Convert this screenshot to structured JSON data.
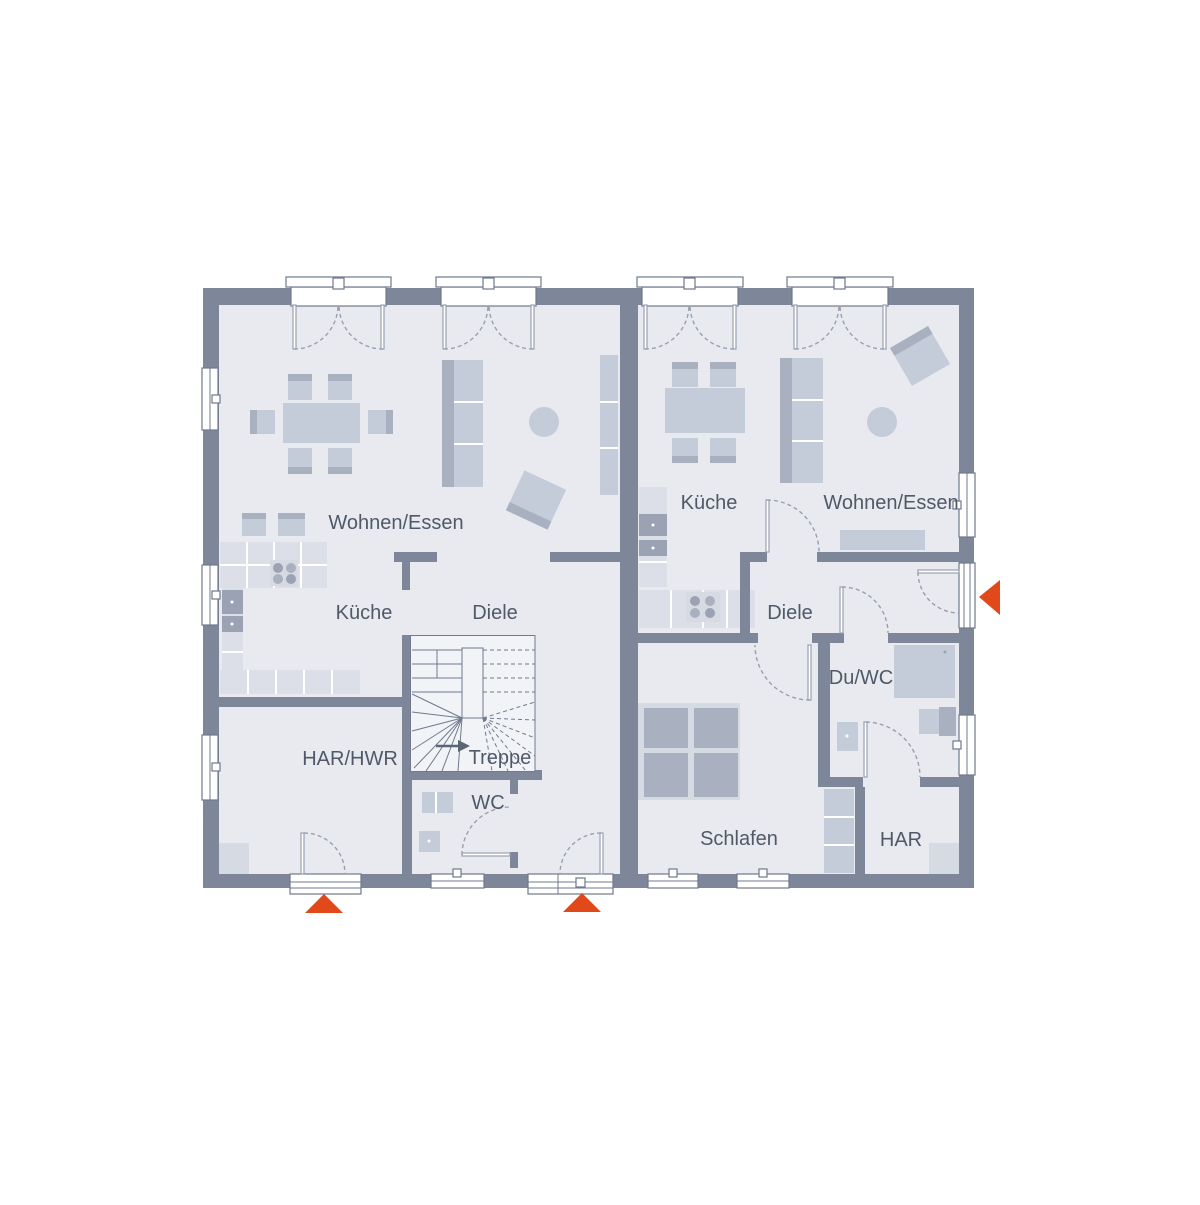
{
  "colors": {
    "wall": "#7d8799",
    "floor": "#e8eaf0",
    "stair_floor": "#f1f3f7",
    "furniture_light": "#d6dae3",
    "furniture_mid": "#c5ccd9",
    "furniture_dark": "#a9b1c1",
    "appliance": "#9aa2b3",
    "kitchen_counter": "#dcdfe8",
    "outline": "#6f7a8c",
    "door_swing": "#98a0b0",
    "label_text": "#4f5968",
    "accent": "#e1491a",
    "background": "#ffffff"
  },
  "units": {
    "left": {
      "rooms": {
        "living": "Wohnen/Essen",
        "kitchen": "Küche",
        "hall": "Diele",
        "utility": "HAR/HWR",
        "stairs": "Treppe",
        "wc": "WC"
      }
    },
    "right": {
      "rooms": {
        "kitchen": "Küche",
        "living": "Wohnen/Essen",
        "hall": "Diele",
        "shower_wc": "Du/WC",
        "bedroom": "Schlafen",
        "storage": "HAR"
      }
    }
  },
  "entrance_markers": {
    "shape": "triangle",
    "count": 3
  }
}
